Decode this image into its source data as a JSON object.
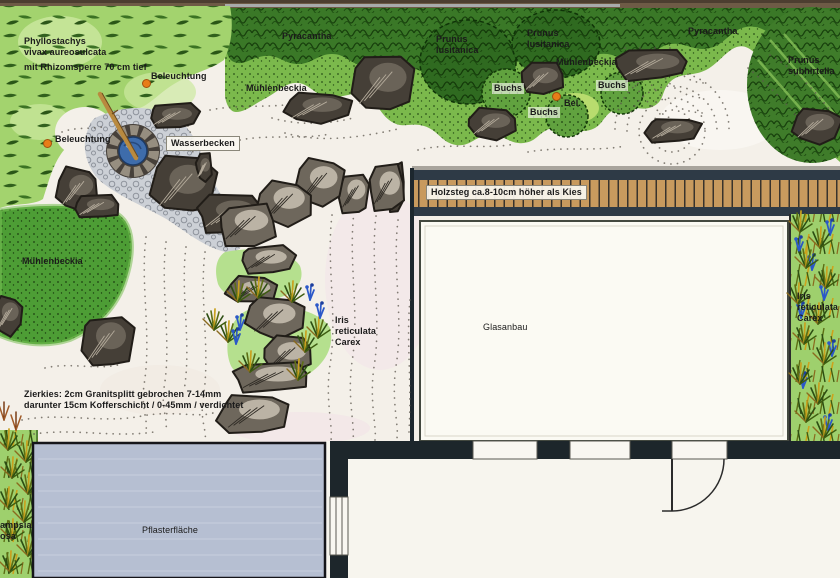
{
  "plan_labels": {
    "phyllostachys": "Phyllostachys\nvivax aureosulcata",
    "rhizomsperre": "mit Rhizomsperre 70 cm tief",
    "beleuchtung_top": "Beleuchtung",
    "beleuchtung_left": "Beleuchtung",
    "beleuchtung_small": "Bel.",
    "pyracantha_left": "Pyracantha",
    "pyracantha_right": "Pyracantha",
    "muehlenbeckia_top": "Mühlenbeckia",
    "muehlenbeckia_mid": "Mühlenbeckia",
    "muehlenbeckia_left": "Mühlenbeckia",
    "prunus_lusitanica_1": "Prunus\nlusitanica",
    "prunus_lusitanica_2": "Prunus\nlusitanica",
    "prunus_subhirtella": "Prunus\nsubhirtella",
    "buchs_1": "Buchs",
    "buchs_2": "Buchs",
    "buchs_3": "Buchs",
    "wasserbecken": "Wasserbecken",
    "holzsteg": "Holzsteg ca.8-10cm höher als Kies",
    "glasanbau": "Glasanbau",
    "iris_mid": "Iris\nreticulata\nCarex",
    "iris_right": "Iris\nreticulata\nCarex",
    "zierkies": "Zierkies: 2cm Granitsplitt gebrochen 7-14mm\ndarunter 15cm Kofferschicht / 0-45mm / verdichtet",
    "pflasterflaeche": "Pflasterfläche",
    "grass_species_partial": "ampsia\nosa"
  },
  "colors": {
    "accent_orange": "#e87d18",
    "gravel": "#f4f0e9",
    "deck_wood": "#c89a5e",
    "water_blue": "#3e6cab",
    "paving_blue_gray": "#b6bfd2",
    "foliage_light": "#a3d36e",
    "foliage_mid": "#7bb94c",
    "foliage_dark": "#3a7827",
    "iris_blue": "#2b58c8"
  }
}
